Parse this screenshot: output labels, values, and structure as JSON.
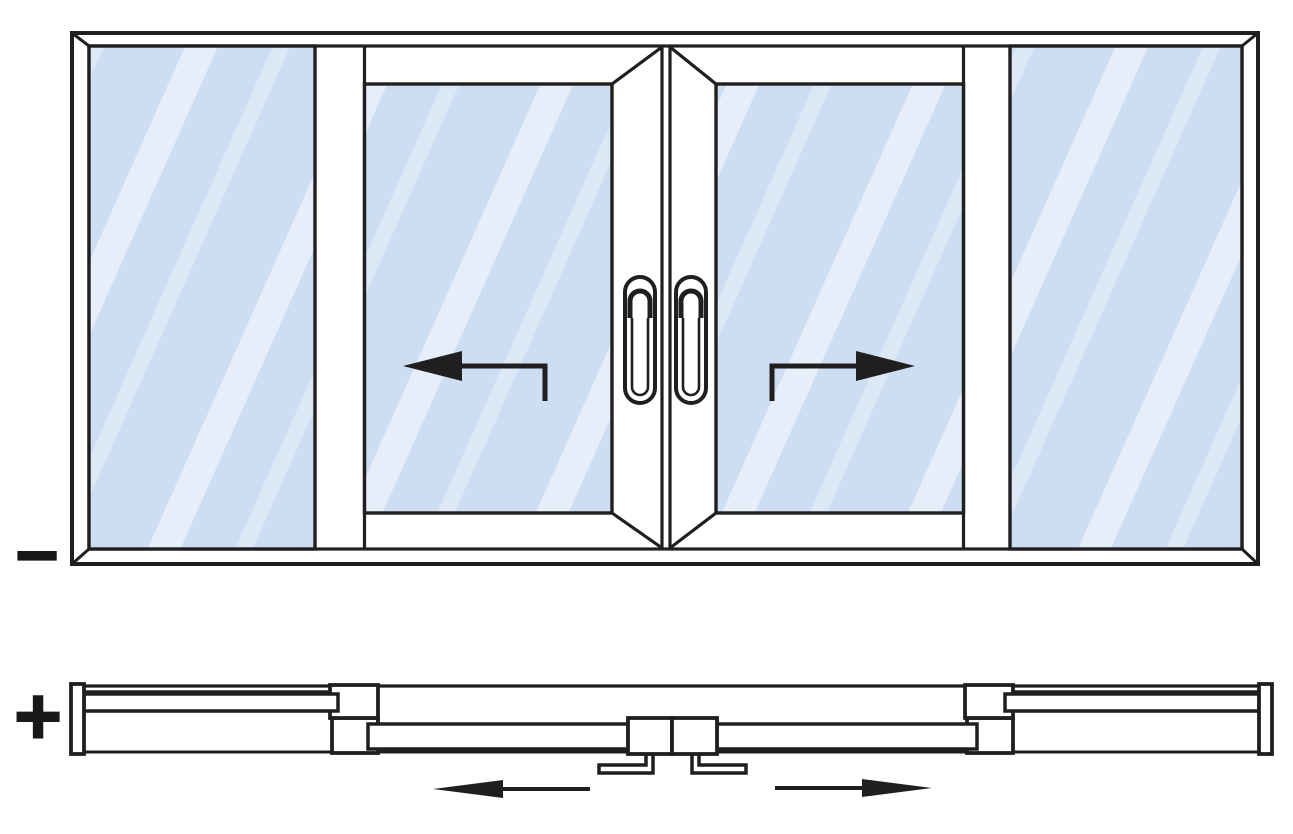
{
  "figure": {
    "kind": "sliding-door-technical-drawing",
    "symbols": {
      "minus": "−",
      "plus": "+"
    },
    "colors": {
      "line": "#211e1f",
      "glass": "#cdddf2",
      "glass_highlight": "#ffffff",
      "symbol": "#1a1718",
      "background": "#ffffff"
    },
    "views": {
      "elevation": {
        "marker": "−",
        "panels": [
          {
            "type": "fixed",
            "position": "left"
          },
          {
            "type": "sliding",
            "position": "center-left",
            "slide_direction": "left",
            "has_handle": true
          },
          {
            "type": "sliding",
            "position": "center-right",
            "slide_direction": "right",
            "has_handle": true
          },
          {
            "type": "fixed",
            "position": "right"
          }
        ],
        "arrows": [
          "left",
          "right"
        ]
      },
      "plan": {
        "marker": "+",
        "arrows": [
          "left",
          "right"
        ]
      }
    }
  }
}
